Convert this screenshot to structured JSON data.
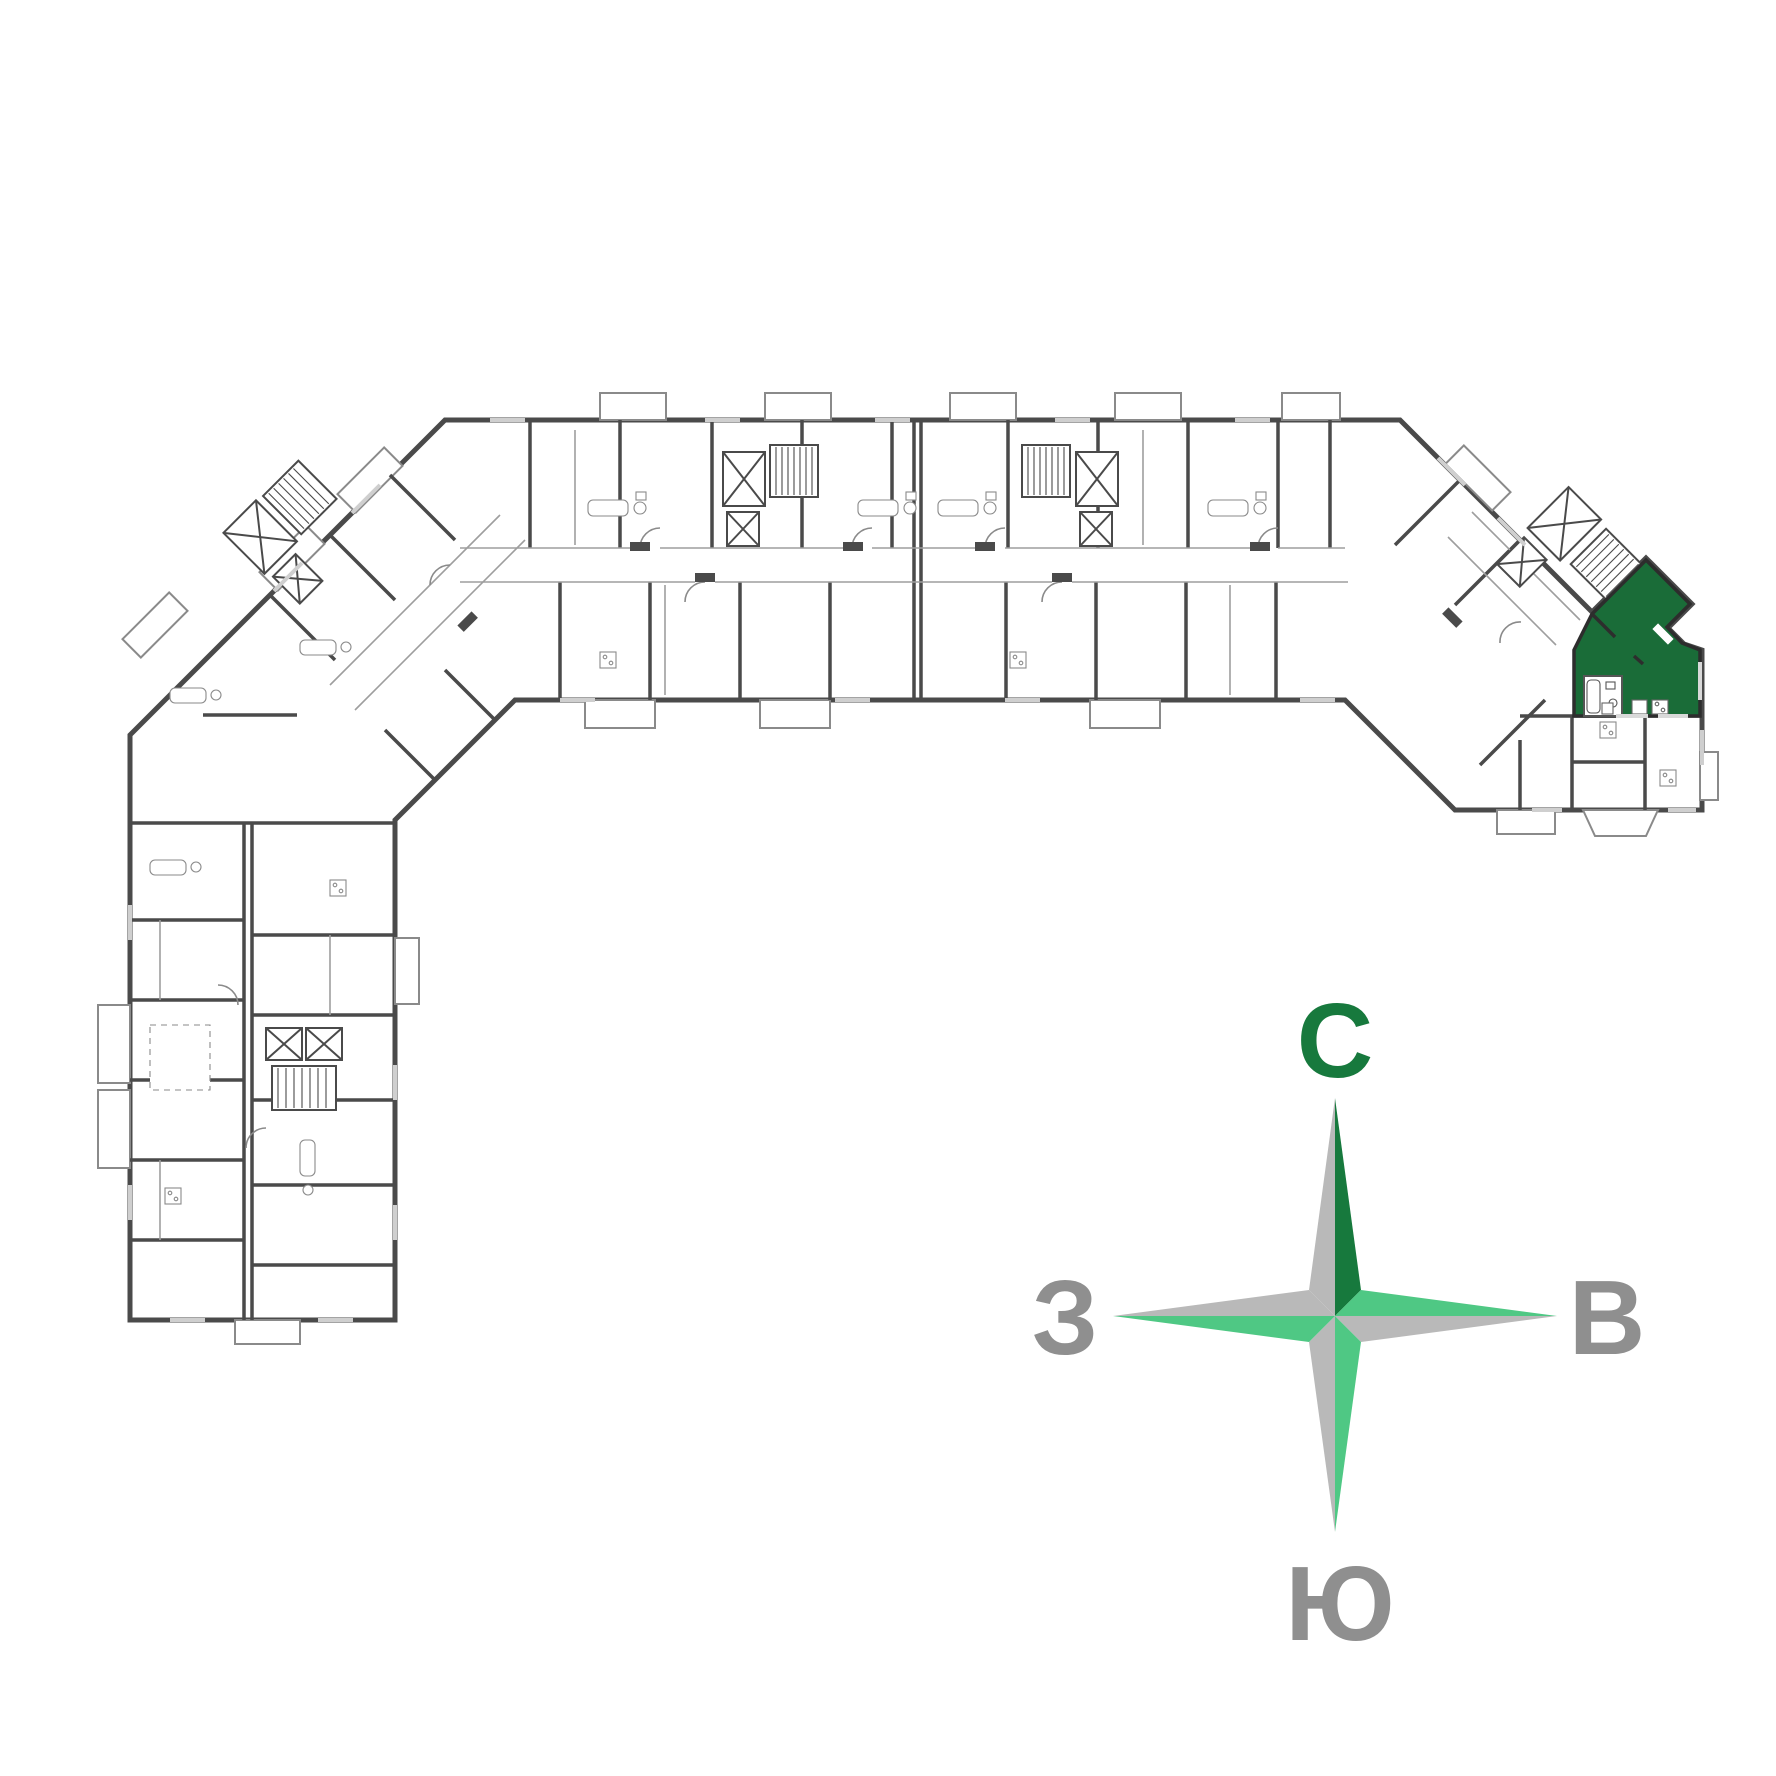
{
  "page": {
    "background": "#ffffff",
    "content_type": "residential-building-floor-plan"
  },
  "floorplan": {
    "highlighted_unit_color": "#1a6c38",
    "highlighted_unit_wall_color": "#2d2d2d",
    "wall_color": "#4a4a4a",
    "detail_color": "#8a8a8a",
    "light_detail_color": "#9e9e9e",
    "window_color": "#cfcfcf",
    "green_window_color": "#d9d9d9",
    "fill_color": "#ffffff"
  },
  "compass": {
    "north_label": "С",
    "east_label": "В",
    "south_label": "Ю",
    "west_label": "З",
    "colors": {
      "dark_green": "#17793d",
      "mid_green": "#4fc884",
      "gray": "#b9b9b9",
      "letter_gray": "#8f8f8f",
      "north_letter": "#17793d"
    }
  }
}
